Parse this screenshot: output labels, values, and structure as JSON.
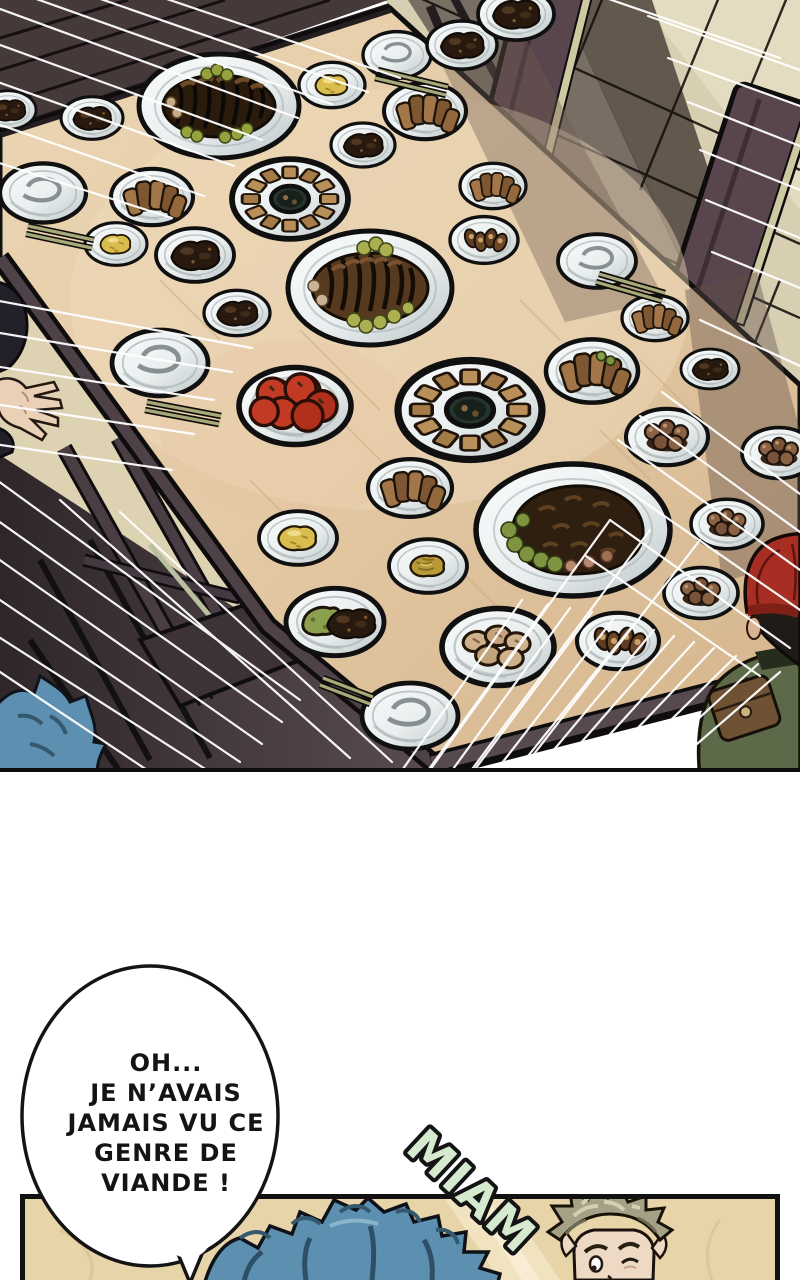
{
  "speech_bubble": {
    "lines": [
      "OH...",
      "JE N’AVAIS",
      "JAMAIS VU CE",
      "GENRE DE",
      "VIANDE !"
    ]
  },
  "sfx": {
    "text": "MIAM"
  },
  "palette": {
    "ink": "#141414",
    "table_wood": "#e4cba7",
    "floor_tiles": "#d8cfb2",
    "floor_boards_dark": "#46393a",
    "panel_background": "#e8d4a9",
    "sfx_fill": "#d6ead0",
    "hair_blue": "#5c8fb0",
    "cap_red": "#a62e22",
    "jacket_green": "#5c6a49",
    "plate_white": "#f2f5f5",
    "tomato_red": "#c23a23"
  }
}
